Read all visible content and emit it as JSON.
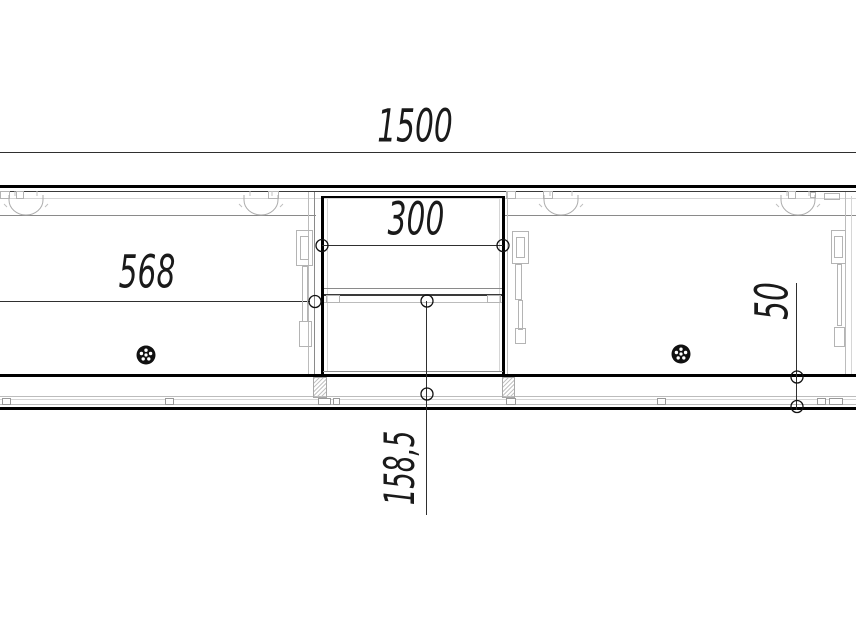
{
  "drawing": {
    "kind": "furniture-front-elevation-technical-drawing",
    "dimensions": {
      "overall_width": "1500",
      "middle_section_width": "300",
      "left_door_width": "568",
      "plinth_height": "50",
      "open_niche_height": "158,5"
    },
    "colors": {
      "heavy_line": "#000000",
      "thin_line": "#3a3a3a",
      "light_line": "#bcbcbc",
      "dimension_line": "#2f2f2f",
      "text": "#1a1a1a",
      "knob_fill": "#111111",
      "background": "#ffffff"
    }
  }
}
